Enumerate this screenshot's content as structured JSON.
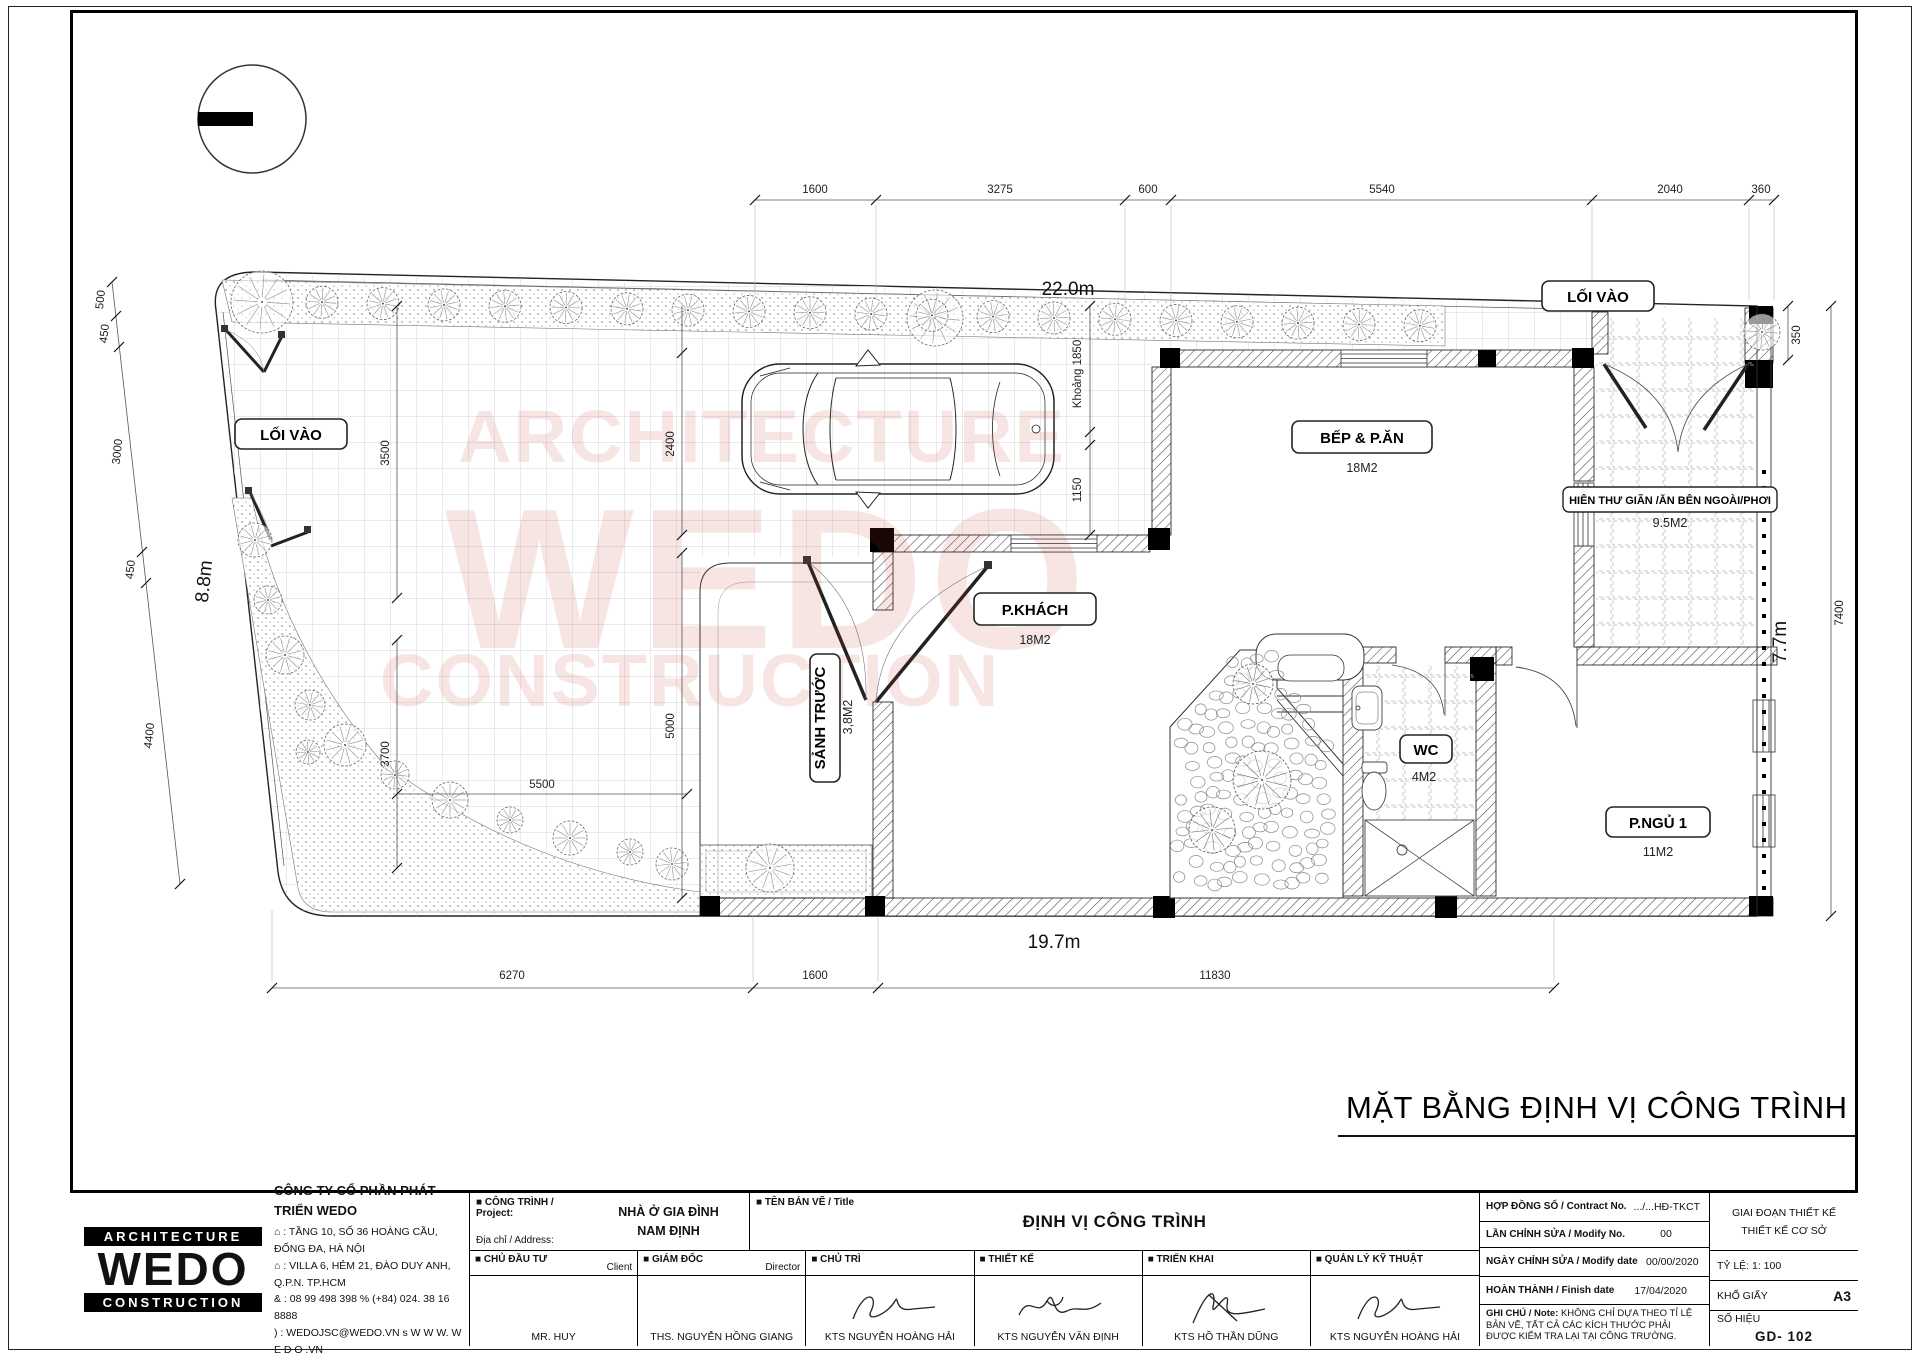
{
  "plan": {
    "title": "MẶT BẰNG ĐỊNH VỊ CÔNG TRÌNH",
    "watermark": {
      "line1": "ARCHITECTURE",
      "line2": "WEDO",
      "line3": "CONSTRUCTION"
    },
    "badges": {
      "loi_vao_left": "LỐI VÀO",
      "loi_vao_top": "LỐI VÀO",
      "bep": "BẾP & P.ĂN",
      "bep_area": "18M2",
      "pkhach": "P.KHÁCH",
      "pkhach_area": "18M2",
      "sanh": "SẢNH TRƯỚC",
      "sanh_area": "3,8M2",
      "wc": "WC",
      "wc_area": "4M2",
      "pngu": "P.NGỦ 1",
      "pngu_area": "11M2",
      "hien": "HIÊN THƯ GIÃN /ĂN BÊN NGOÀI/PHƠI",
      "hien_area": "9.5M2"
    },
    "overall": {
      "top": "22.0m",
      "bottom": "19.7m",
      "left": "8.8m",
      "right": "7.7m"
    },
    "dims_top": [
      "1600",
      "3275",
      "600",
      "5540",
      "2040",
      "360"
    ],
    "dims_bottom": [
      "6270",
      "1600",
      "11830"
    ],
    "dims_left": [
      "500",
      "450",
      "3000",
      "450",
      "4400"
    ],
    "dims_right": [
      "350",
      "7400"
    ],
    "dims_inner": [
      "3500",
      "2400",
      "Khoảng 1850",
      "1150",
      "3700",
      "5000",
      "5500"
    ]
  },
  "titleblock": {
    "logo": {
      "line1": "ARCHITECTURE",
      "line2": "WEDO",
      "line3": "CONSTRUCTION"
    },
    "company": {
      "name": "CÔNG TY CỔ PHẦN PHÁT TRIỂN WEDO",
      "addr1": "⌂ : TẦNG 10, SỐ 36 HOÀNG CẦU, ĐỐNG ĐA, HÀ NỘI",
      "addr2": "⌂ : VILLA 6, HẺM 21, ĐÀO DUY ANH, Q.P.N.  TP.HCM",
      "phones": "& : 08 99 498 398      % (+84) 024. 38 16 8888",
      "web": ") : WEDOJSC@WEDO.VN    s W W W. W E D O .VN"
    },
    "project": {
      "label": "■ CÔNG TRÌNH / Project:",
      "address_label": "Địa chỉ / Address:",
      "name_line1": "NHÀ Ở GIA ĐÌNH",
      "name_line2": "NAM ĐỊNH"
    },
    "drawing": {
      "label": "■ TÊN BẢN VẼ / Title",
      "value": "ĐỊNH VỊ CÔNG TRÌNH"
    },
    "people": [
      {
        "label": "■ CHỦ ĐẦU TƯ",
        "sub": "Client",
        "name": "MR. HUY"
      },
      {
        "label": "■ GIÁM ĐỐC",
        "sub": "Director",
        "name": "THS. NGUYỄN HỒNG GIANG"
      },
      {
        "label": "■ CHỦ TRÌ",
        "sub": "",
        "name": "KTS NGUYỄN HOÀNG HẢI"
      },
      {
        "label": "■ THIẾT KẾ",
        "sub": "",
        "name": "KTS NGUYỄN VĂN ĐỊNH"
      },
      {
        "label": "■ TRIỂN KHAI",
        "sub": "",
        "name": "KTS HỒ THẦN DŨNG"
      },
      {
        "label": "■ QUẢN LÝ KỸ THUẬT",
        "sub": "",
        "name": "KTS NGUYỄN HOÀNG HẢI"
      }
    ],
    "meta": [
      {
        "label": "HỢP ĐỒNG SỐ / Contract No.",
        "value": ".../...HĐ-TKCT"
      },
      {
        "label": "LẦN CHỈNH SỬA / Modify No.",
        "value": "00"
      },
      {
        "label": "NGÀY CHỈNH SỬA / Modify date",
        "value": "00/00/2020"
      },
      {
        "label": "HOÀN THÀNH / Finish date",
        "value": "17/04/2020"
      }
    ],
    "note": {
      "label": "GHI CHÚ / Note:",
      "value": " KHÔNG CHỈ DỰA THEO TỈ LỆ BẢN VẼ, TẤT CẢ CÁC KÍCH THƯỚC PHẢI ĐƯỢC KIỂM TRA LẠI TẠI CÔNG TRƯỜNG."
    },
    "stage": {
      "line1": "GIAI ĐOẠN THIẾT KẾ",
      "line2": "THIẾT KẾ CƠ SỞ",
      "scale": "TỶ LỆ: 1: 100",
      "paper_label": "KHỔ GIẤY",
      "paper": "A3",
      "no_label": "SỐ HIỆU",
      "no": "GD- 102"
    }
  }
}
